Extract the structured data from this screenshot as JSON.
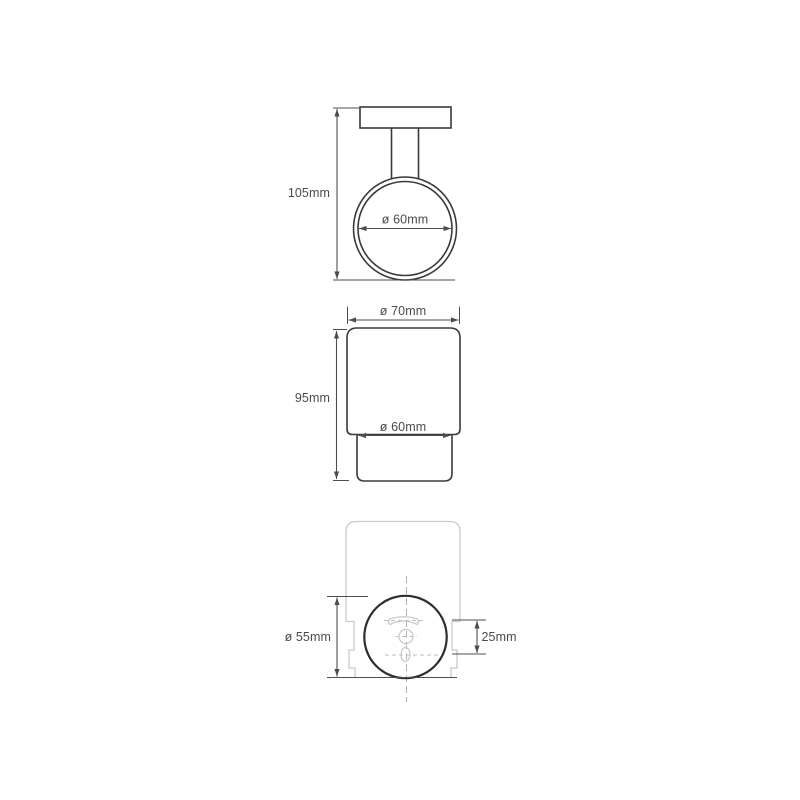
{
  "drawing": {
    "colors": {
      "background": "#ffffff",
      "outline": "#3a3a3a",
      "mount_plate_outline": "#2e2e2e",
      "dimension_lines": "#4d4d4d",
      "ghost_lines": "#c9c9c9",
      "centerlines": "#b3b3b3",
      "label_text": "#4a4a4a"
    },
    "side_view": {
      "height_label": "105mm",
      "ring_diameter_label": "ø 60mm"
    },
    "front_view": {
      "rim_diameter_label": "ø 70mm",
      "height_label": "95mm",
      "base_diameter_label": "ø 60mm"
    },
    "mount_view": {
      "plate_diameter_label": "ø 55mm",
      "hole_spacing_label": "25mm"
    }
  }
}
